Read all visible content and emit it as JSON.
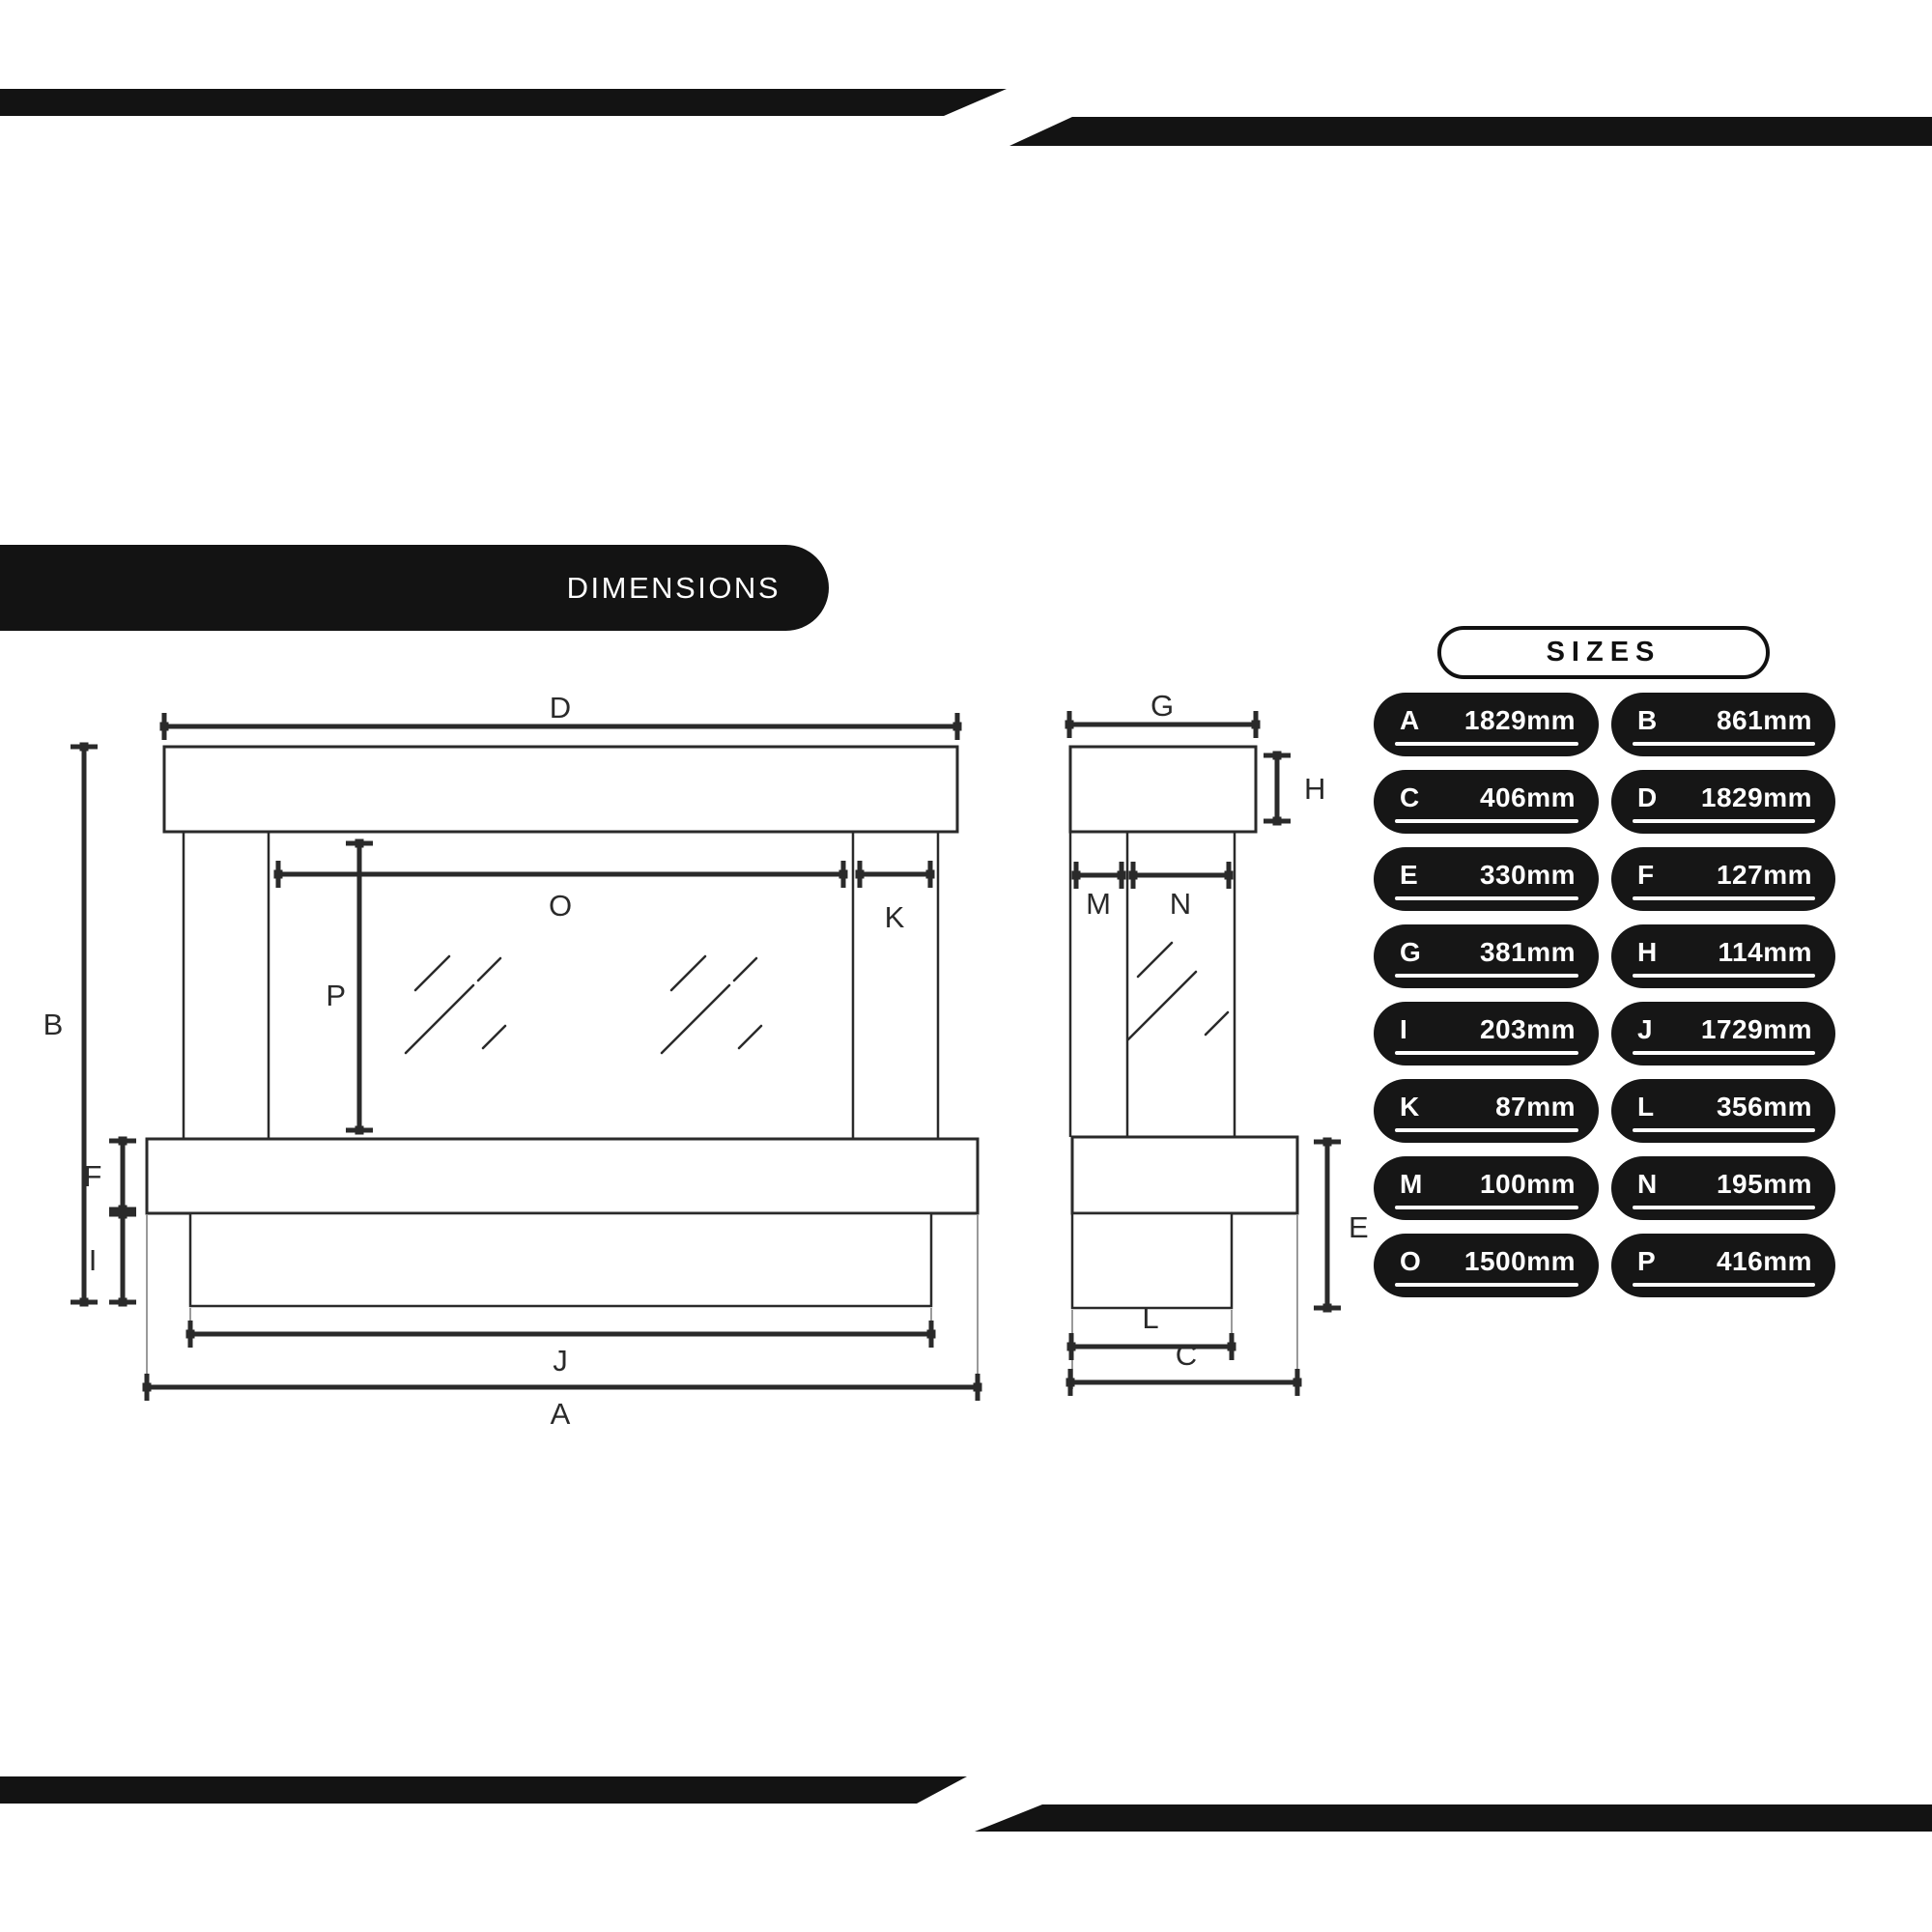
{
  "header": {
    "title": "DIMENSIONS"
  },
  "sizes_panel": {
    "title": "SIZES",
    "entries": [
      {
        "key": "A",
        "value": "1829mm"
      },
      {
        "key": "B",
        "value": "861mm"
      },
      {
        "key": "C",
        "value": "406mm"
      },
      {
        "key": "D",
        "value": "1829mm"
      },
      {
        "key": "E",
        "value": "330mm"
      },
      {
        "key": "F",
        "value": "127mm"
      },
      {
        "key": "G",
        "value": "381mm"
      },
      {
        "key": "H",
        "value": "114mm"
      },
      {
        "key": "I",
        "value": "203mm"
      },
      {
        "key": "J",
        "value": "1729mm"
      },
      {
        "key": "K",
        "value": "87mm"
      },
      {
        "key": "L",
        "value": "356mm"
      },
      {
        "key": "M",
        "value": "100mm"
      },
      {
        "key": "N",
        "value": "195mm"
      },
      {
        "key": "O",
        "value": "1500mm"
      },
      {
        "key": "P",
        "value": "416mm"
      }
    ]
  },
  "front_view": {
    "dim_labels": {
      "D": "D",
      "B": "B",
      "O": "O",
      "K": "K",
      "P": "P",
      "F": "F",
      "I": "I",
      "J": "J",
      "A": "A"
    }
  },
  "side_view": {
    "dim_labels": {
      "G": "G",
      "H": "H",
      "M": "M",
      "N": "N",
      "E": "E",
      "L": "L",
      "C": "C"
    }
  },
  "colors": {
    "ink": "#2a2a2a",
    "bar": "#131313",
    "badge_bg": "#161616",
    "badge_text": "#ffffff"
  }
}
